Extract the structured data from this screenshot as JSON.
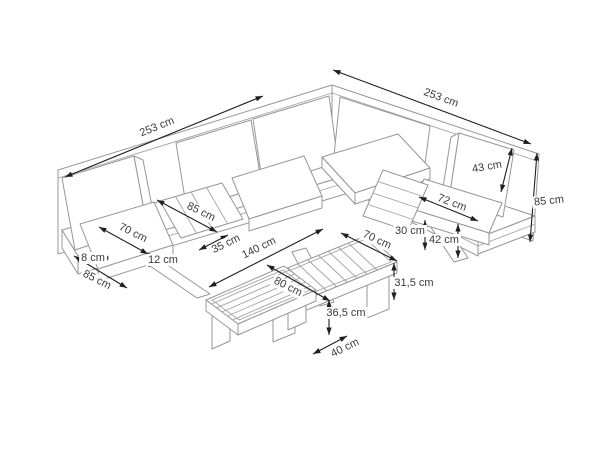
{
  "page": {
    "background": "#ffffff"
  },
  "drawing": {
    "subject": "corner garden sofa with slatted inserts, coffee table and bench, isometric dimension diagram",
    "furniture_line_color": "#979797",
    "dimension_line_color": "#1f1f1f",
    "text_color": "#3a3a3a",
    "unit": "cm"
  },
  "dimensions": {
    "sofa_back_left_length": "253 cm",
    "sofa_back_right_length": "253 cm",
    "backrest_cushion_height": "43 cm",
    "sofa_total_height": "85 cm",
    "right_seat_cushion_depth": "72 cm",
    "middle_slat_shelf_depth": "85 cm",
    "left_seat_cushion_depth": "70 cm",
    "slat_shelf_width": "35 cm",
    "platform_height": "30 cm",
    "seat_height_with_cushion": "42 cm",
    "base_frame_height": "8 cm",
    "seat_cushion_thickness": "12 cm",
    "sofa_end_depth": "85 cm",
    "table_length": "140 cm",
    "table_width": "70 cm",
    "table_height": "31,5 cm",
    "bench_length": "80 cm",
    "bench_height": "36,5 cm",
    "bench_width": "40 cm"
  }
}
